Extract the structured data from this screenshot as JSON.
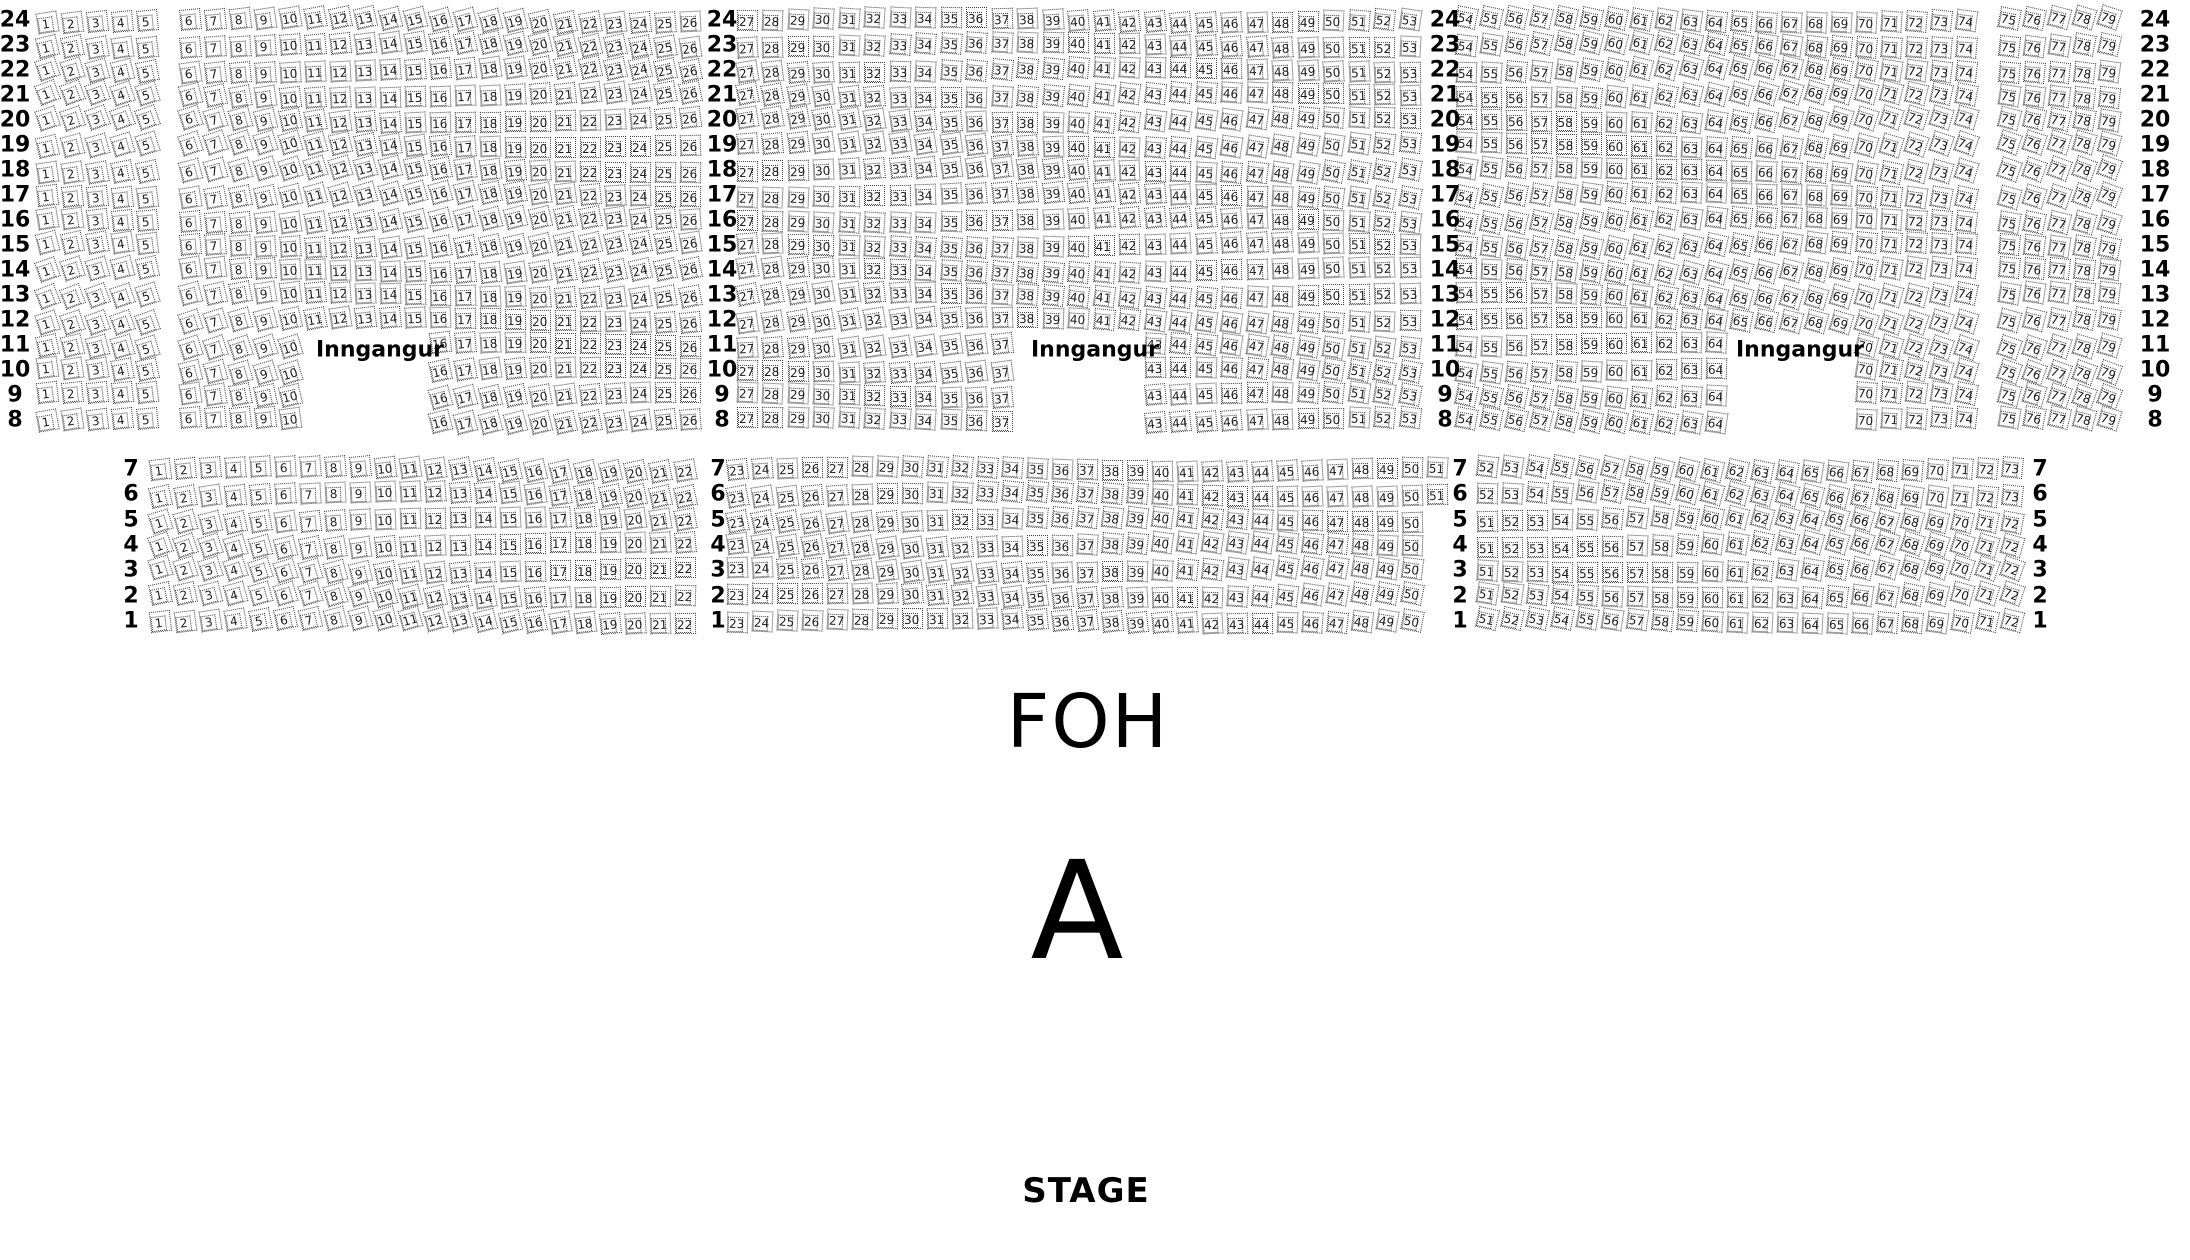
{
  "labels": {
    "entrance": "Inngangur",
    "foh": "FOH",
    "section_letter": "A",
    "stage": "STAGE"
  },
  "top_section": {
    "rows": [
      {
        "row": 24,
        "segments": [
          [
            1,
            79
          ]
        ]
      },
      {
        "row": 23,
        "segments": [
          [
            1,
            79
          ]
        ]
      },
      {
        "row": 22,
        "segments": [
          [
            1,
            79
          ]
        ]
      },
      {
        "row": 21,
        "segments": [
          [
            1,
            79
          ]
        ]
      },
      {
        "row": 20,
        "segments": [
          [
            1,
            79
          ]
        ]
      },
      {
        "row": 19,
        "segments": [
          [
            1,
            79
          ]
        ]
      },
      {
        "row": 18,
        "segments": [
          [
            1,
            79
          ]
        ]
      },
      {
        "row": 17,
        "segments": [
          [
            1,
            79
          ]
        ]
      },
      {
        "row": 16,
        "segments": [
          [
            1,
            79
          ]
        ]
      },
      {
        "row": 15,
        "segments": [
          [
            1,
            79
          ]
        ]
      },
      {
        "row": 14,
        "segments": [
          [
            1,
            79
          ]
        ]
      },
      {
        "row": 13,
        "segments": [
          [
            1,
            79
          ]
        ]
      },
      {
        "row": 12,
        "segments": [
          [
            1,
            79
          ]
        ]
      },
      {
        "row": 11,
        "segments": [
          [
            1,
            10
          ],
          [
            16,
            37
          ],
          [
            43,
            64
          ],
          [
            70,
            79
          ]
        ]
      },
      {
        "row": 10,
        "segments": [
          [
            1,
            10
          ],
          [
            16,
            37
          ],
          [
            43,
            64
          ],
          [
            70,
            79
          ]
        ]
      },
      {
        "row": 9,
        "segments": [
          [
            1,
            10
          ],
          [
            16,
            37
          ],
          [
            43,
            64
          ],
          [
            70,
            79
          ]
        ]
      },
      {
        "row": 8,
        "segments": [
          [
            1,
            10
          ],
          [
            16,
            37
          ],
          [
            43,
            64
          ],
          [
            70,
            79
          ]
        ]
      }
    ]
  },
  "bottom_section": {
    "rows": [
      {
        "row": 7,
        "segments": [
          [
            1,
            73
          ]
        ]
      },
      {
        "row": 6,
        "segments": [
          [
            1,
            73
          ]
        ]
      },
      {
        "row": 5,
        "segments": [
          [
            1,
            72
          ]
        ]
      },
      {
        "row": 4,
        "segments": [
          [
            1,
            72
          ]
        ]
      },
      {
        "row": 3,
        "segments": [
          [
            1,
            72
          ]
        ]
      },
      {
        "row": 2,
        "segments": [
          [
            1,
            72
          ]
        ]
      },
      {
        "row": 1,
        "segments": [
          [
            1,
            72
          ]
        ]
      }
    ]
  }
}
